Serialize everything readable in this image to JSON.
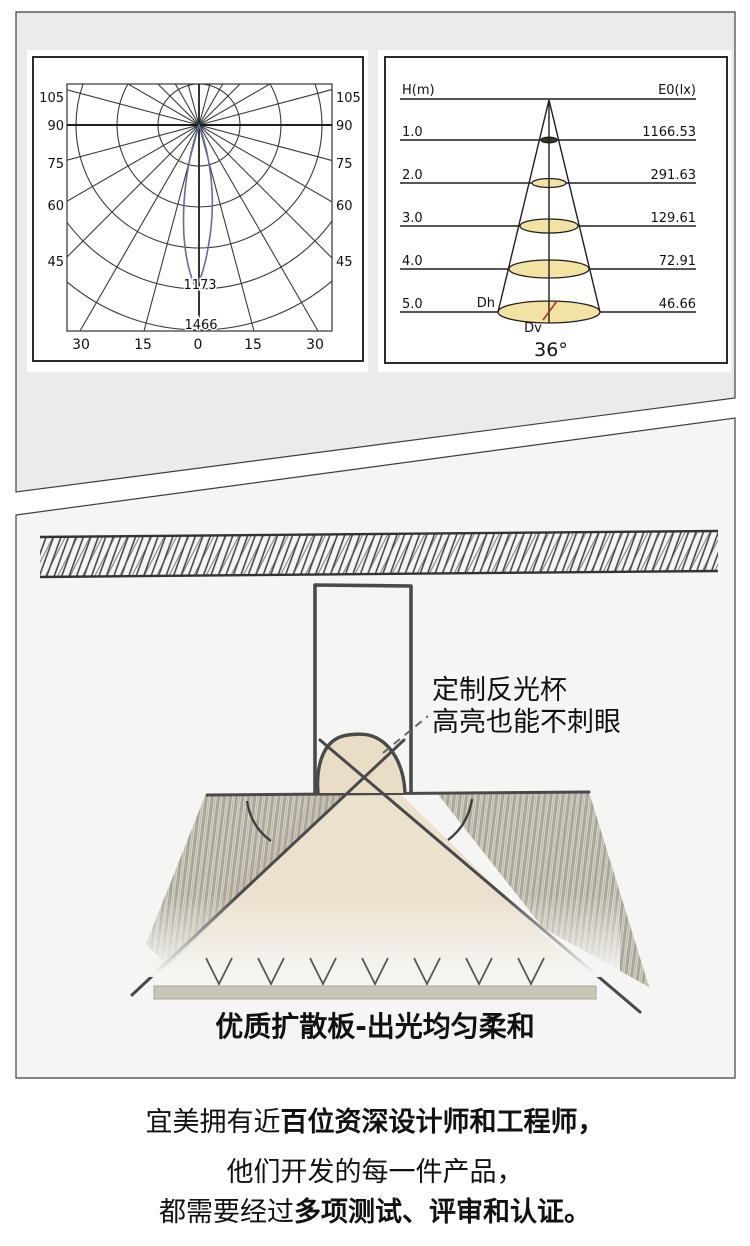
{
  "photometric_card": {
    "polar_chart": {
      "left_axis_labels": [
        "105",
        "90",
        "75",
        "60",
        "45"
      ],
      "right_axis_labels": [
        "105",
        "90",
        "75",
        "60",
        "45"
      ],
      "bottom_axis_labels": [
        "30",
        "15",
        "0",
        "15",
        "30"
      ],
      "ring_labels": [
        "1173",
        "1466"
      ]
    },
    "cone_chart": {
      "col_height": "H(m)",
      "col_illuminance": "E0(lx)",
      "rows": [
        {
          "h": "1.0",
          "e0": "1166.53"
        },
        {
          "h": "2.0",
          "e0": "291.63"
        },
        {
          "h": "3.0",
          "e0": "129.61"
        },
        {
          "h": "4.0",
          "e0": "72.91"
        },
        {
          "h": "5.0",
          "e0": "46.66"
        }
      ],
      "dh": "Dh",
      "dv": "Dv",
      "beam_angle": "36°"
    }
  },
  "structure_card": {
    "annotation_line1": "定制反光杯",
    "annotation_line2": "高亮也能不刺眼",
    "caption": "优质扩散板-出光均匀柔和"
  },
  "footer": {
    "l1a": "宜美拥有近",
    "l1b": "百位资深设计师和工程师，",
    "l2": "他们开发的每一件产品，",
    "l3a": "都需要经过",
    "l3b": "多项测试、评审和认证。"
  },
  "colors": {
    "card1_bg": "#ebebeb",
    "card2_bg": "#f5f5f3",
    "panel_bg": "#ffffff",
    "ink": "#111111",
    "curve_blue": "#5f6fa0",
    "ellipse_yellow": "#f2e3a2",
    "red_marker": "#b23030",
    "beam_beige": "#ece1cc",
    "dome_beige": "#e9ddc6",
    "hatch_taupe": "#aaa697",
    "diffuser_bar": "#c9c5b8"
  },
  "chart_data": [
    {
      "type": "line",
      "title": "Polar luminous intensity distribution curve",
      "side_angle_ticks": [
        105,
        90,
        75,
        60,
        45
      ],
      "bottom_angle_ticks": [
        30,
        15,
        0,
        15,
        30
      ],
      "ring_values": [
        1173,
        1466
      ],
      "series": [
        {
          "name": "intensity curve",
          "description": "narrow lobe centered on 0°, peak ~1466 cd, width ~±15°"
        }
      ],
      "grid": "polar, rings every ~293 cd, radials every 15°, legend none"
    },
    {
      "type": "table",
      "title": "Illuminance cone diagram, beam angle 36°",
      "columns": [
        "H(m)",
        "E0(lx)"
      ],
      "rows": [
        [
          1.0,
          1166.53
        ],
        [
          2.0,
          291.63
        ],
        [
          3.0,
          129.61
        ],
        [
          4.0,
          72.91
        ],
        [
          5.0,
          46.66
        ]
      ],
      "annotations": [
        "Dh",
        "Dv",
        "36°"
      ]
    }
  ]
}
